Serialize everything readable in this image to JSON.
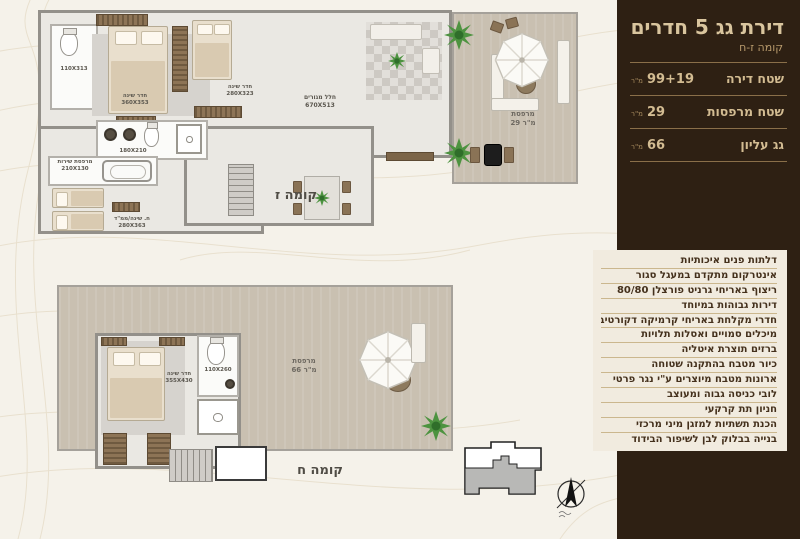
{
  "panel": {
    "title": "דירת גג 5 חדרים",
    "subtitle": "קומה ז-ח",
    "stats": [
      {
        "label": "שטח דירה",
        "value": "99+19",
        "unit": "מ\"ר"
      },
      {
        "label": "שטח מרפסות",
        "value": "29",
        "unit": "מ\"ר"
      },
      {
        "label": "גג עליון",
        "value": "66",
        "unit": "מ\"ר"
      }
    ],
    "features": [
      "דלתות פנים איכותיות",
      "אינטרקום מתקדם במעגל סגור",
      "ריצוף באריחי גרניט פורצלן 80/80",
      "דירות גבוהות במיוחד",
      "חדרי מקלחת באריחי קרמיקה דקורטיבים",
      "מיכלים סמויים ואסלות תלויות",
      "ברזים תוצרת איטליה",
      "כיור מטבח בהתקנה שטוחה",
      "ארונות מטבח מיוצרים ע\"י נגר פרטי",
      "לובי כניסה גבוה ומעוצב",
      "חניון תת קרקעי",
      "הכנת תשתיות למזגן מיני מרכזי",
      "בנייה בבלוק לבן לשיפור הבידוד"
    ]
  },
  "floor7": {
    "label": "קומה ז",
    "rooms": {
      "bath_top": {
        "dims": "110X313"
      },
      "master": {
        "name": "חדר שינה",
        "dims": "360X353"
      },
      "bedroom2": {
        "name": "חדר שינה",
        "dims": "280X323"
      },
      "living": {
        "name": "חלל מגורים",
        "dims": "670X513"
      },
      "bath_mid": {
        "dims": "180X210"
      },
      "service": {
        "name": "מרפסת שירות",
        "dims": "210X130"
      },
      "mamad": {
        "name": "ח. שינה/ממ\"ד",
        "dims": "280X363"
      },
      "balcony": {
        "name": "מרפסת",
        "area": "29 מ\"ר"
      }
    }
  },
  "floor8": {
    "label": "קומה ח",
    "rooms": {
      "bedroom": {
        "name": "חדר שינה",
        "dims": "355X430"
      },
      "bath": {
        "dims": "110X260"
      },
      "roof_terrace": {
        "name": "מרפסת",
        "area": "66 מ\"ר"
      }
    }
  }
}
